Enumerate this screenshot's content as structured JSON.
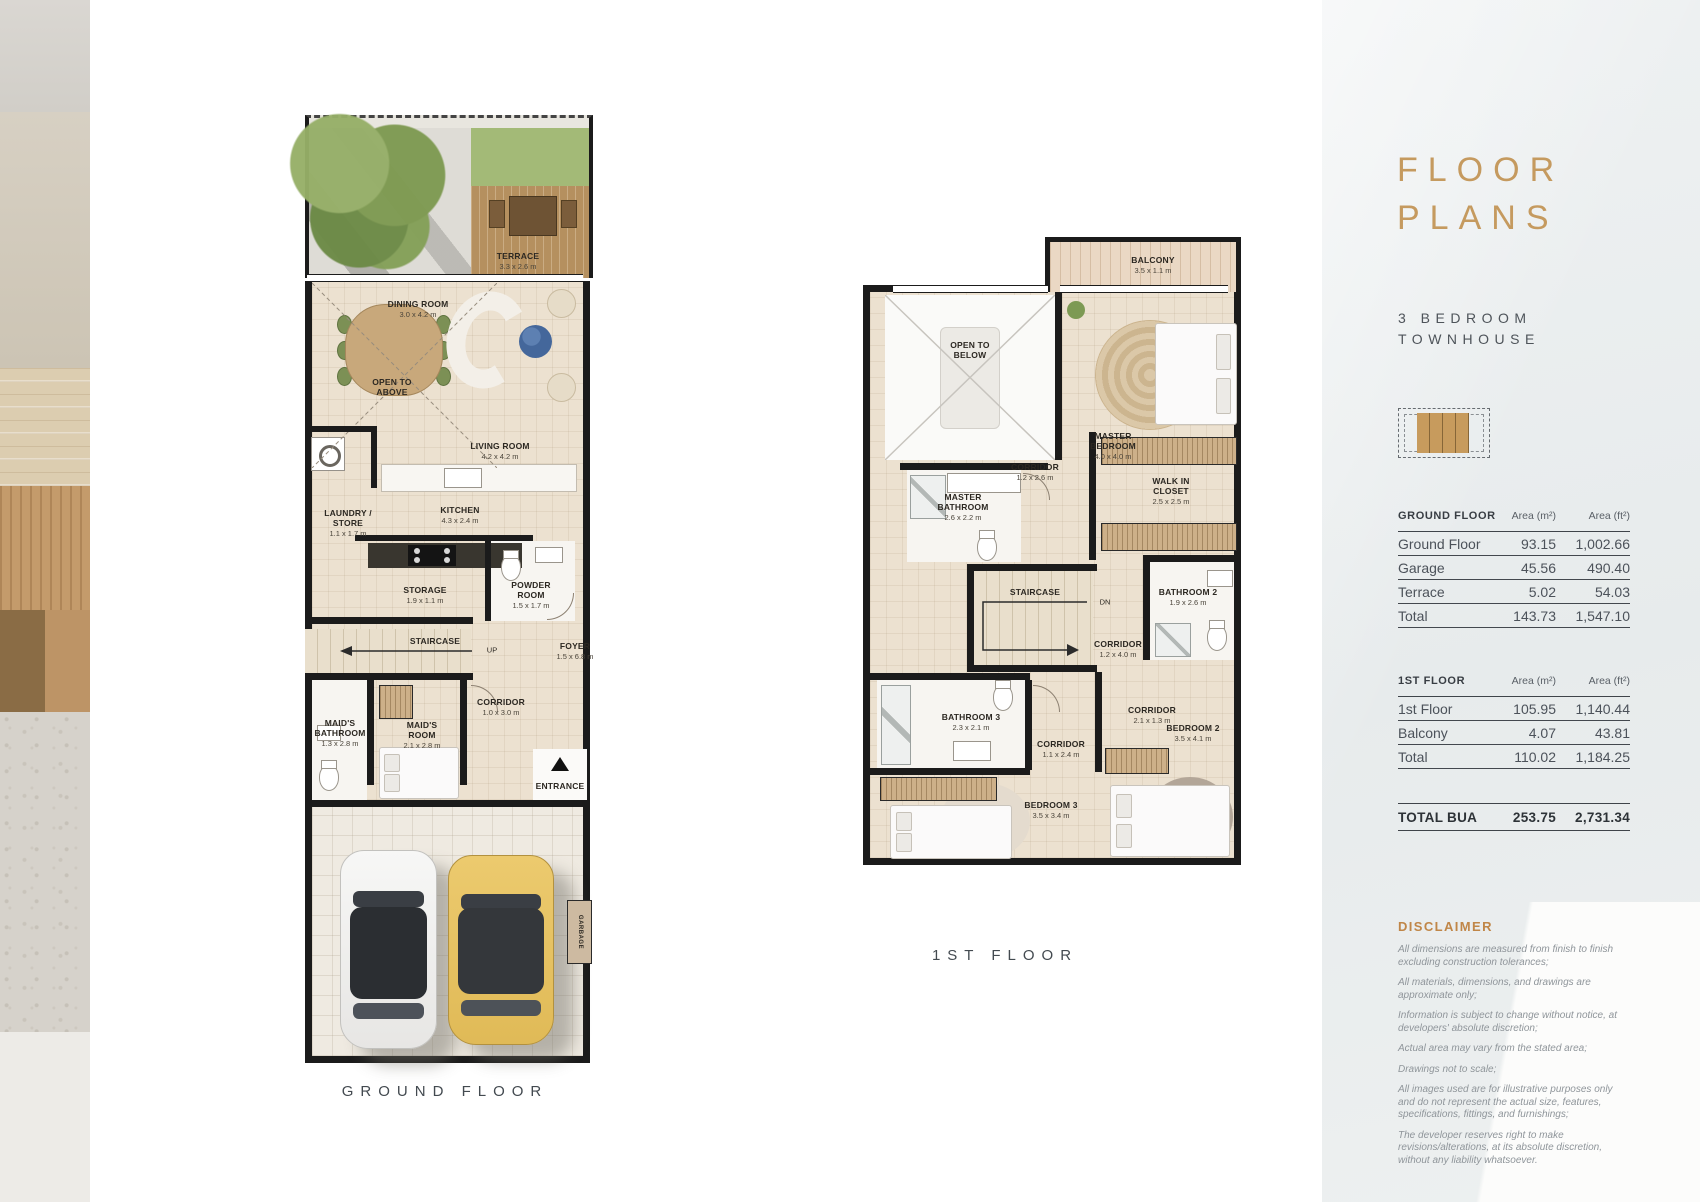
{
  "ground_plan": {
    "caption": "GROUND FLOOR",
    "rooms": {
      "terrace": {
        "name": "TERRACE",
        "dims": "3.3 x 2.6 m"
      },
      "dining": {
        "name": "DINING ROOM",
        "dims": "3.0 x 4.2 m"
      },
      "open_above": {
        "name": "OPEN TO ABOVE"
      },
      "living": {
        "name": "LIVING ROOM",
        "dims": "4.2 x 4.2 m"
      },
      "laundry": {
        "name": "LAUNDRY / STORE",
        "dims": "1.1 x 1.7 m"
      },
      "kitchen": {
        "name": "KITCHEN",
        "dims": "4.3 x 2.4 m"
      },
      "storage": {
        "name": "STORAGE",
        "dims": "1.9 x 1.1 m"
      },
      "powder": {
        "name": "POWDER ROOM",
        "dims": "1.5 x 1.7 m"
      },
      "staircase": {
        "name": "STAIRCASE",
        "direction": "UP"
      },
      "foyer": {
        "name": "FOYER",
        "dims": "1.5 x 6.8 m"
      },
      "maids_bathroom": {
        "name": "MAID'S BATHROOM",
        "dims": "1.3 x 2.8 m"
      },
      "maids_room": {
        "name": "MAID'S ROOM",
        "dims": "2.1 x 2.8 m"
      },
      "corridor": {
        "name": "CORRIDOR",
        "dims": "1.0 x 3.0 m"
      },
      "entrance": {
        "name": "ENTRANCE"
      },
      "garbage": {
        "name": "GARBAGE"
      }
    }
  },
  "first_plan": {
    "caption": "1ST FLOOR",
    "rooms": {
      "balcony": {
        "name": "BALCONY",
        "dims": "3.5 x 1.1 m"
      },
      "open_below": {
        "name": "OPEN TO BELOW"
      },
      "master_bedroom": {
        "name": "MASTER BEDROOM",
        "dims": "4.0 x 4.0 m"
      },
      "master_bathroom": {
        "name": "MASTER BATHROOM",
        "dims": "2.6 x 2.2 m"
      },
      "corridor_a": {
        "name": "CORRIDOR",
        "dims": "1.2 x 2.6 m"
      },
      "walk_in_closet": {
        "name": "WALK IN CLOSET",
        "dims": "2.5 x 2.5 m"
      },
      "bathroom_2": {
        "name": "BATHROOM 2",
        "dims": "1.9 x 2.6 m"
      },
      "staircase": {
        "name": "STAIRCASE",
        "direction": "DN"
      },
      "corridor_b": {
        "name": "CORRIDOR",
        "dims": "1.2 x 4.0 m"
      },
      "corridor_c": {
        "name": "CORRIDOR",
        "dims": "2.1 x 1.3 m"
      },
      "bathroom_3": {
        "name": "BATHROOM 3",
        "dims": "2.3 x 2.1 m"
      },
      "corridor_d": {
        "name": "CORRIDOR",
        "dims": "1.1 x 2.4 m"
      },
      "bedroom_3": {
        "name": "BEDROOM 3",
        "dims": "3.5 x 3.4 m"
      },
      "bedroom_2": {
        "name": "BEDROOM 2",
        "dims": "3.5 x 4.1 m"
      }
    }
  },
  "sidebar": {
    "title_line1": "FLOOR",
    "title_line2": "PLANS",
    "subtitle_line1": "3 BEDROOM",
    "subtitle_line2": "TOWNHOUSE",
    "accent_color": "#c59a5f",
    "tables": [
      {
        "header": "GROUND FLOOR",
        "col_m2": "Area (m²)",
        "col_ft2": "Area (ft²)",
        "rows": [
          {
            "label": "Ground Floor",
            "m2": "93.15",
            "ft2": "1,002.66"
          },
          {
            "label": "Garage",
            "m2": "45.56",
            "ft2": "490.40"
          },
          {
            "label": "Terrace",
            "m2": "5.02",
            "ft2": "54.03"
          },
          {
            "label": "Total",
            "m2": "143.73",
            "ft2": "1,547.10"
          }
        ]
      },
      {
        "header": "1ST FLOOR",
        "col_m2": "Area (m²)",
        "col_ft2": "Area (ft²)",
        "rows": [
          {
            "label": "1st Floor",
            "m2": "105.95",
            "ft2": "1,140.44"
          },
          {
            "label": "Balcony",
            "m2": "4.07",
            "ft2": "43.81"
          },
          {
            "label": "Total",
            "m2": "110.02",
            "ft2": "1,184.25"
          }
        ]
      }
    ],
    "total_bua": {
      "label": "TOTAL BUA",
      "m2": "253.75",
      "ft2": "2,731.34"
    },
    "disclaimer": {
      "heading": "DISCLAIMER",
      "items": [
        "All dimensions are measured from finish to finish excluding construction tolerances;",
        "All materials, dimensions, and drawings are approximate only;",
        "Information is subject to change without notice, at developers' absolute discretion;",
        "Actual area may vary from the stated area;",
        "Drawings not to scale;",
        "All images used are for illustrative purposes only and do not represent the actual size, features, specifications, fittings, and furnishings;",
        "The developer reserves right to make revisions/alterations, at its absolute discretion, without any liability whatsoever."
      ]
    }
  }
}
